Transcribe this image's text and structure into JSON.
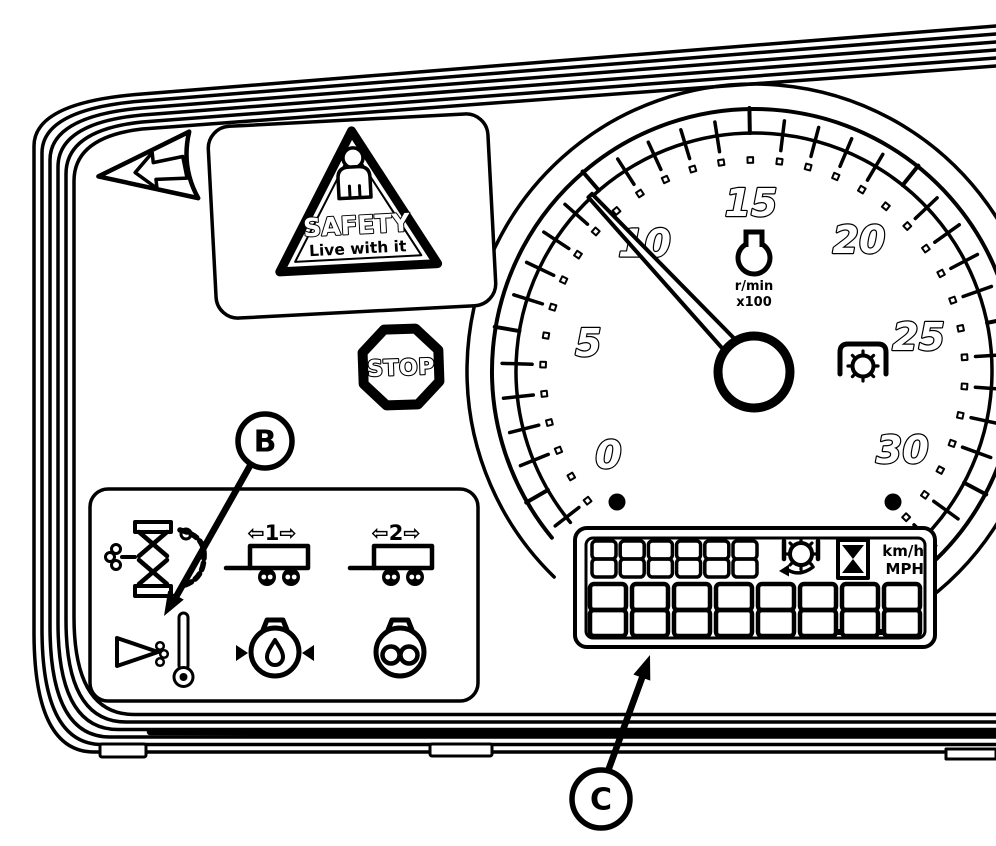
{
  "figure": {
    "description": "Tractor instrument cluster line diagram",
    "ink": "#000000",
    "paper": "#ffffff"
  },
  "callouts": {
    "b_label": "B",
    "c_label": "C"
  },
  "direction_arrow": {
    "name": "left-direction-arrow"
  },
  "safety_sign": {
    "heading": "SAFETY",
    "subheading": "Live with it"
  },
  "stop_sign": {
    "label": "STOP"
  },
  "tachometer": {
    "unit_top": "r/min",
    "unit_bottom": "x100",
    "min": 0,
    "max": 30,
    "major_step": 5,
    "labels": [
      "0",
      "5",
      "10",
      "15",
      "20",
      "25",
      "30"
    ],
    "needle_value": 9.7,
    "start_angle_deg": 150,
    "sweep_deg": 238
  },
  "indicator_panel": {
    "icons": [
      {
        "name": "air-filter-restriction-icon"
      },
      {
        "name": "trailer-1-turn-signal-icon",
        "label": "⇦1⇨"
      },
      {
        "name": "trailer-2-turn-signal-icon",
        "label": "⇦2⇨"
      },
      {
        "name": "transmission-oil-temperature-icon"
      },
      {
        "name": "transmission-oil-pressure-icon"
      },
      {
        "name": "differential-lock-icon"
      }
    ]
  },
  "lcd": {
    "top_digits": "888888",
    "bottom_digits": "88888888",
    "decimal_points_after": [
      6,
      7
    ],
    "unit_labels": [
      "km/h",
      "MPH"
    ],
    "icons": [
      "gear-icon",
      "hourglass-icon"
    ]
  }
}
